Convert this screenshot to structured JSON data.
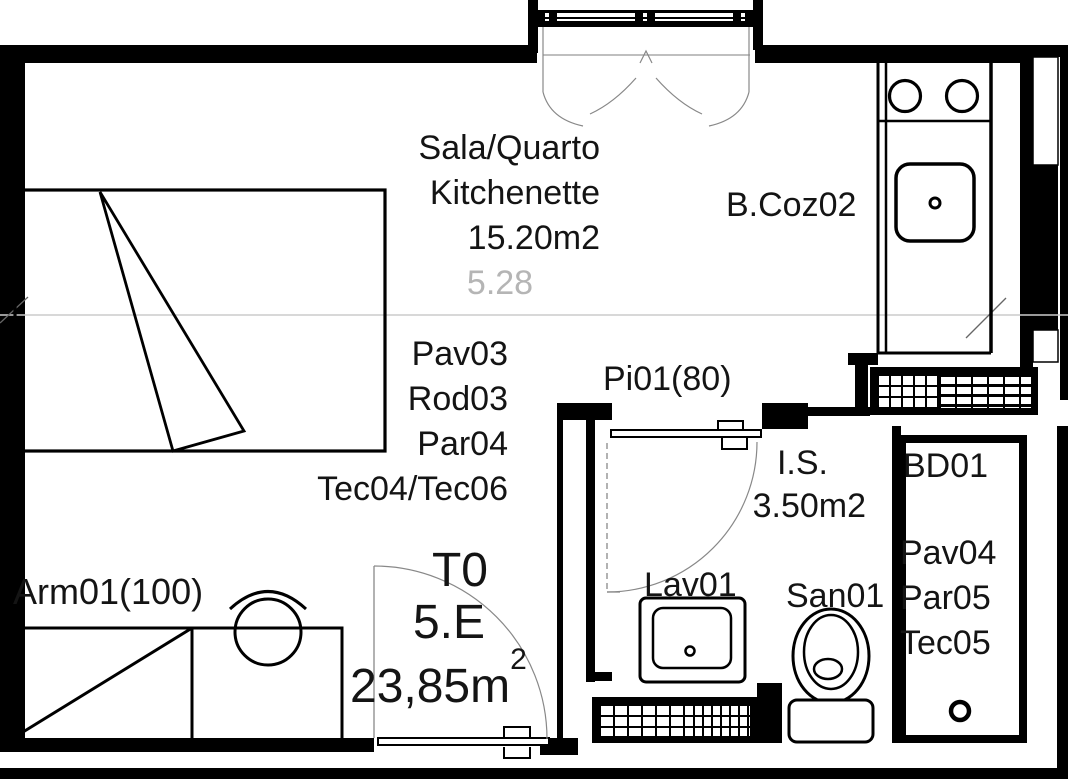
{
  "drawing": {
    "unit": {
      "type": "T0",
      "floor_unit": "5.E",
      "area": "23,85m",
      "area_exponent": "2"
    },
    "rooms": {
      "living": {
        "name_line1": "Sala/Quarto",
        "name_line2": "Kitchenette",
        "area": "15.20m2",
        "dimension": "5.28",
        "finish_floor": "Pav03",
        "finish_skirting": "Rod03",
        "finish_wall": "Par04",
        "finish_ceiling": "Tec04/Tec06"
      },
      "kitchen": {
        "label": "B.Coz02"
      },
      "bathroom": {
        "label": "I.S.",
        "area": "3.50m2",
        "sink_label": "Lav01",
        "toilet_label": "San01"
      },
      "shower": {
        "label": "BD01",
        "finish_floor": "Pav04",
        "finish_wall": "Par05",
        "finish_ceiling": "Tec05"
      }
    },
    "doors": {
      "bathroom_door": "Pi01(80)"
    },
    "furniture": {
      "wardrobe": "Arm01(100)"
    },
    "colors": {
      "line": "#000000",
      "dim_text": "#b5b5b5",
      "swing": "#888888",
      "section_line": "#cccccc"
    }
  }
}
